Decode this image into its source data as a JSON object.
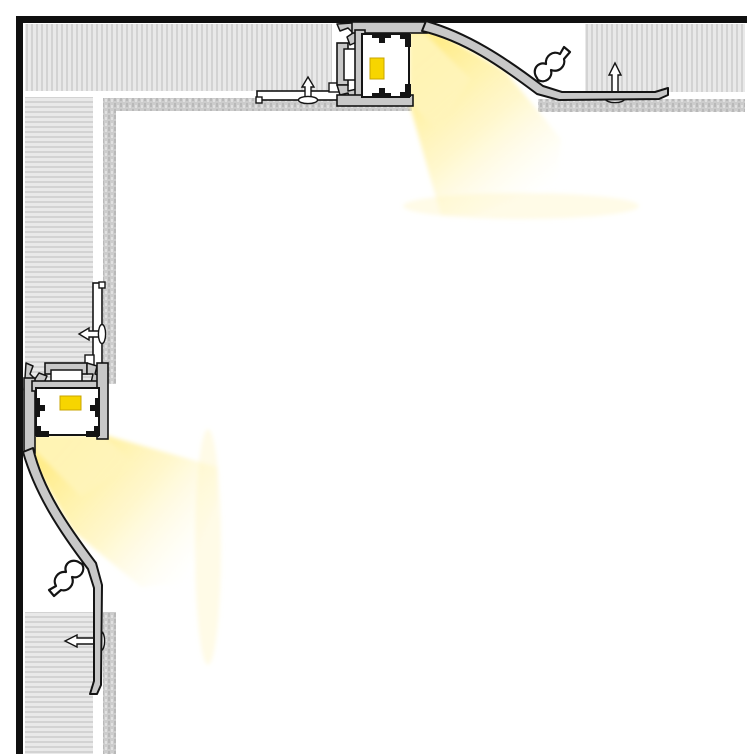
{
  "canvas": {
    "width": 754,
    "height": 754,
    "background": "#ffffff"
  },
  "diagram_meta": {
    "kind": "technical-cross-section",
    "subject": "recessed-led-cove-profile-at-ceiling-and-wall-corner",
    "text_labels": []
  },
  "palette": {
    "background": "#ffffff",
    "structure_border": "#101010",
    "outline": "#141414",
    "drywall_base": "#e9e9e9",
    "drywall_stripe": "#d3d3d3",
    "skimcoat_base": "#cccccc",
    "skimcoat_dark": "#b9b9b9",
    "skimcoat_light": "#e0e0e0",
    "aluminum": "#c8c8c8",
    "diffuser_white": "#ffffff",
    "led_chip": "#f7d500",
    "led_chip_edge": "#c9a500",
    "beam_bright": "#ffec85",
    "beam_mid": "#fff2ab",
    "beam_faint": "#fffbe3"
  },
  "defs": {
    "patterns": [
      {
        "id": "hatchV",
        "width": 5,
        "height": 8,
        "shapes": [
          {
            "tag": "rect",
            "attrs": {
              "x": 0,
              "y": 0,
              "width": 5,
              "height": 8,
              "fill": "#e9e9e9"
            }
          },
          {
            "tag": "rect",
            "attrs": {
              "x": 1,
              "y": 0,
              "width": 2,
              "height": 8,
              "fill": "#d3d3d3"
            }
          }
        ]
      },
      {
        "id": "hatchH",
        "width": 8,
        "height": 5,
        "shapes": [
          {
            "tag": "rect",
            "attrs": {
              "x": 0,
              "y": 0,
              "width": 8,
              "height": 5,
              "fill": "#e9e9e9"
            }
          },
          {
            "tag": "rect",
            "attrs": {
              "x": 0,
              "y": 1,
              "width": 8,
              "height": 2,
              "fill": "#d3d3d3"
            }
          }
        ]
      },
      {
        "id": "stipple",
        "width": 6,
        "height": 6,
        "shapes": [
          {
            "tag": "rect",
            "attrs": {
              "x": 0,
              "y": 0,
              "width": 6,
              "height": 6,
              "fill": "#cccccc"
            }
          },
          {
            "tag": "rect",
            "attrs": {
              "x": 0,
              "y": 1,
              "width": 2,
              "height": 4,
              "fill": "#b9b9b9"
            }
          },
          {
            "tag": "rect",
            "attrs": {
              "x": 3,
              "y": 3,
              "width": 2,
              "height": 3,
              "fill": "#e0e0e0"
            }
          }
        ]
      }
    ],
    "gradients": [
      {
        "id": "beamGrad",
        "x1": 425,
        "y1": 55,
        "x2": 545,
        "y2": 195,
        "stops": [
          {
            "offset": "0",
            "color": "#ffec85",
            "opacity": "0.95"
          },
          {
            "offset": "0.5",
            "color": "#fff2ab",
            "opacity": "0.6"
          },
          {
            "offset": "1",
            "color": "#fffbe3",
            "opacity": "0"
          }
        ]
      }
    ],
    "filters": [
      {
        "id": "soft",
        "blur": 2
      }
    ]
  },
  "assembly": {
    "id": "led-profile-assembly",
    "shapes": [
      {
        "tag": "g",
        "name": "led-light-beam",
        "attrs": {
          "filter": "url(#soft)"
        },
        "children": [
          {
            "tag": "polygon",
            "name": "beam-main",
            "attrs": {
              "points": "409,33 429,27 505,71 561,139 558,181 474,215 441,215 409,103",
              "fill": "url(#beamGrad)"
            }
          },
          {
            "tag": "polygon",
            "name": "beam-core",
            "attrs": {
              "points": "409,35 424,33 470,79 437,129 409,101",
              "fill": "#fff5bb",
              "opacity": "0.85"
            }
          },
          {
            "tag": "ellipse",
            "name": "beam-falloff",
            "attrs": {
              "cx": 521,
              "cy": 206,
              "rx": 118,
              "ry": 13,
              "fill": "#fff3b0",
              "opacity": "0.3"
            }
          }
        ]
      },
      {
        "tag": "rect",
        "name": "plaster-flange",
        "attrs": {
          "x": 257,
          "y": 91,
          "width": 84,
          "height": 9,
          "fill": "#ffffff",
          "stroke": "#141414",
          "stroke-width": 1.6
        }
      },
      {
        "tag": "rect",
        "name": "plaster-flange-lip",
        "attrs": {
          "x": 256,
          "y": 97,
          "width": 6,
          "height": 6,
          "fill": "#ffffff",
          "stroke": "#141414",
          "stroke-width": 1.4
        }
      },
      {
        "tag": "rect",
        "name": "plaster-flange-tab",
        "attrs": {
          "x": 329,
          "y": 83,
          "width": 13,
          "height": 9,
          "fill": "#ffffff",
          "stroke": "#141414",
          "stroke-width": 1.4
        }
      },
      {
        "tag": "path",
        "name": "screw-flange-shaft",
        "attrs": {
          "d": "M305,97 L305,87 L302,87 L308,77 L314,87 L311,87 L311,97 Z",
          "fill": "#ffffff",
          "stroke": "#141414",
          "stroke-width": 1.4
        }
      },
      {
        "tag": "ellipse",
        "name": "screw-flange-head",
        "attrs": {
          "cx": 308,
          "cy": 100,
          "rx": 9.5,
          "ry": 3.6,
          "fill": "#ffffff",
          "stroke": "#141414",
          "stroke-width": 1.4
        }
      },
      {
        "tag": "path",
        "name": "screw-wing-shaft",
        "attrs": {
          "d": "M612,96 L612,75 L609,75 L615,63 L621,75 L618,75 L618,96 Z",
          "fill": "#ffffff",
          "stroke": "#141414",
          "stroke-width": 1.4
        }
      },
      {
        "tag": "ellipse",
        "name": "screw-wing-head",
        "attrs": {
          "cx": 615,
          "cy": 99,
          "rx": 9.5,
          "ry": 3.6,
          "fill": "#ffffff",
          "stroke": "#141414",
          "stroke-width": 1.4
        }
      },
      {
        "tag": "path",
        "name": "mount-teeth-upper",
        "attrs": {
          "d": "M364,22 L364,34 L357,34 L359,41 L350,45 L347,37 L353,33 L348,28 L340,31 L337,24 L352,23 Z",
          "fill": "#c8c8c8",
          "stroke": "#141414",
          "stroke-width": 1.5,
          "stroke-linejoin": "round"
        }
      },
      {
        "tag": "rect",
        "name": "profile-top-plate",
        "attrs": {
          "x": 352,
          "y": 22,
          "width": 75,
          "height": 11,
          "fill": "#c8c8c8",
          "stroke": "#141414",
          "stroke-width": 1.6
        }
      },
      {
        "tag": "rect",
        "name": "mount-bar",
        "attrs": {
          "x": 337,
          "y": 43,
          "width": 11,
          "height": 42,
          "fill": "#c8c8c8",
          "stroke": "#141414",
          "stroke-width": 1.6
        }
      },
      {
        "tag": "rect",
        "name": "mount-bar-slot",
        "attrs": {
          "x": 344,
          "y": 49,
          "width": 14,
          "height": 31,
          "fill": "#ffffff",
          "stroke": "#141414",
          "stroke-width": 1.5
        }
      },
      {
        "tag": "path",
        "name": "mount-teeth-lower",
        "attrs": {
          "d": "M337,85 L348,85 L348,91 L357,89 L360,97 L350,100 L348,93 L340,95 Z",
          "fill": "#c8c8c8",
          "stroke": "#141414",
          "stroke-width": 1.5,
          "stroke-linejoin": "round"
        }
      },
      {
        "tag": "rect",
        "name": "channel-back-wall",
        "attrs": {
          "x": 355,
          "y": 30,
          "width": 10,
          "height": 67,
          "fill": "#c8c8c8",
          "stroke": "#141414",
          "stroke-width": 1.6
        }
      },
      {
        "tag": "rect",
        "name": "profile-bottom-plate",
        "attrs": {
          "x": 337,
          "y": 95,
          "width": 76,
          "height": 11,
          "fill": "#c8c8c8",
          "stroke": "#141414",
          "stroke-width": 1.6
        }
      },
      {
        "tag": "rect",
        "name": "led-channel-housing",
        "attrs": {
          "x": 362,
          "y": 34,
          "width": 47,
          "height": 63,
          "fill": "#ffffff",
          "stroke": "#141414",
          "stroke-width": 2
        }
      },
      {
        "tag": "path",
        "name": "strip-groove-top",
        "attrs": {
          "d": "M372,34 H391 V38 H385 V43 H379 V38 H372 Z",
          "fill": "#141414"
        }
      },
      {
        "tag": "path",
        "name": "strip-groove-bottom",
        "attrs": {
          "d": "M372,97 H391 V93 H385 V88 H379 V93 H372 Z",
          "fill": "#141414"
        }
      },
      {
        "tag": "path",
        "name": "aperture-lip-top",
        "attrs": {
          "d": "M400,34 H411 V47 H405 V39 H400 Z",
          "fill": "#141414"
        }
      },
      {
        "tag": "path",
        "name": "aperture-lip-bottom",
        "attrs": {
          "d": "M400,97 H411 V84 H405 V92 H400 Z",
          "fill": "#141414"
        }
      },
      {
        "tag": "rect",
        "name": "led-chip",
        "attrs": {
          "x": 370,
          "y": 58,
          "width": 14,
          "height": 21,
          "fill": "#f7d500",
          "stroke": "#c9a500",
          "stroke-width": 1
        }
      },
      {
        "tag": "path",
        "name": "curved-wing",
        "attrs": {
          "d": "M426,21 C468,33 505,57 543,86 L562,92 L655,92 L668,88 L668,95 L659,99 L559,100 L537,94 C500,66 464,41 422,31 Z",
          "fill": "#c8c8c8",
          "stroke": "#141414",
          "stroke-width": 2,
          "stroke-linejoin": "round"
        }
      },
      {
        "tag": "path",
        "name": "spring-clip",
        "attrs": {
          "d": "M537,78 C531,70 538,61 546,64 C545,56 553,50 560,54 L564,47 L570,52 L564,59 C566,66 559,73 551,70 C553,78 545,84 538,80 Z",
          "fill": "#ffffff",
          "stroke": "#141414",
          "stroke-width": 2.2,
          "stroke-linejoin": "round"
        }
      }
    ],
    "instances": [
      {
        "name": "ceiling-profile-assembly",
        "transform": null
      },
      {
        "name": "wall-profile-assembly",
        "transform": "matrix(0,1,1,0,2,26)"
      }
    ]
  },
  "scene": [
    {
      "tag": "rect",
      "name": "structural-border-top",
      "attrs": {
        "x": 16,
        "y": 16,
        "width": 731,
        "height": 7,
        "fill": "#101010"
      }
    },
    {
      "tag": "rect",
      "name": "structural-border-left",
      "attrs": {
        "x": 16,
        "y": 16,
        "width": 7,
        "height": 738,
        "fill": "#101010"
      }
    },
    {
      "tag": "rect",
      "name": "ceiling-drywall-left-block",
      "attrs": {
        "x": 25,
        "y": 24,
        "width": 307,
        "height": 67,
        "fill": "url(#hatchV)"
      }
    },
    {
      "tag": "rect",
      "name": "ceiling-drywall-right-block",
      "attrs": {
        "x": 585,
        "y": 24,
        "width": 160,
        "height": 68,
        "fill": "url(#hatchV)"
      }
    },
    {
      "tag": "rect",
      "name": "wall-drywall-upper-block",
      "attrs": {
        "x": 25,
        "y": 97,
        "width": 68,
        "height": 287,
        "fill": "url(#hatchH)"
      }
    },
    {
      "tag": "rect",
      "name": "wall-drywall-lower-block",
      "attrs": {
        "x": 25,
        "y": 612,
        "width": 68,
        "height": 142,
        "fill": "url(#hatchH)"
      }
    },
    {
      "tag": "rect",
      "name": "ceiling-skimcoat-strip-inner",
      "attrs": {
        "x": 103,
        "y": 98,
        "width": 309,
        "height": 13,
        "fill": "url(#stipple)"
      }
    },
    {
      "tag": "rect",
      "name": "ceiling-skimcoat-strip-outer",
      "attrs": {
        "x": 538,
        "y": 99,
        "width": 207,
        "height": 13,
        "fill": "url(#stipple)"
      }
    },
    {
      "tag": "rect",
      "name": "wall-skimcoat-strip-inner",
      "attrs": {
        "x": 103,
        "y": 98,
        "width": 13,
        "height": 286,
        "fill": "url(#stipple)"
      }
    },
    {
      "tag": "rect",
      "name": "wall-skimcoat-strip-outer",
      "attrs": {
        "x": 103,
        "y": 612,
        "width": 13,
        "height": 142,
        "fill": "url(#stipple)"
      }
    }
  ]
}
